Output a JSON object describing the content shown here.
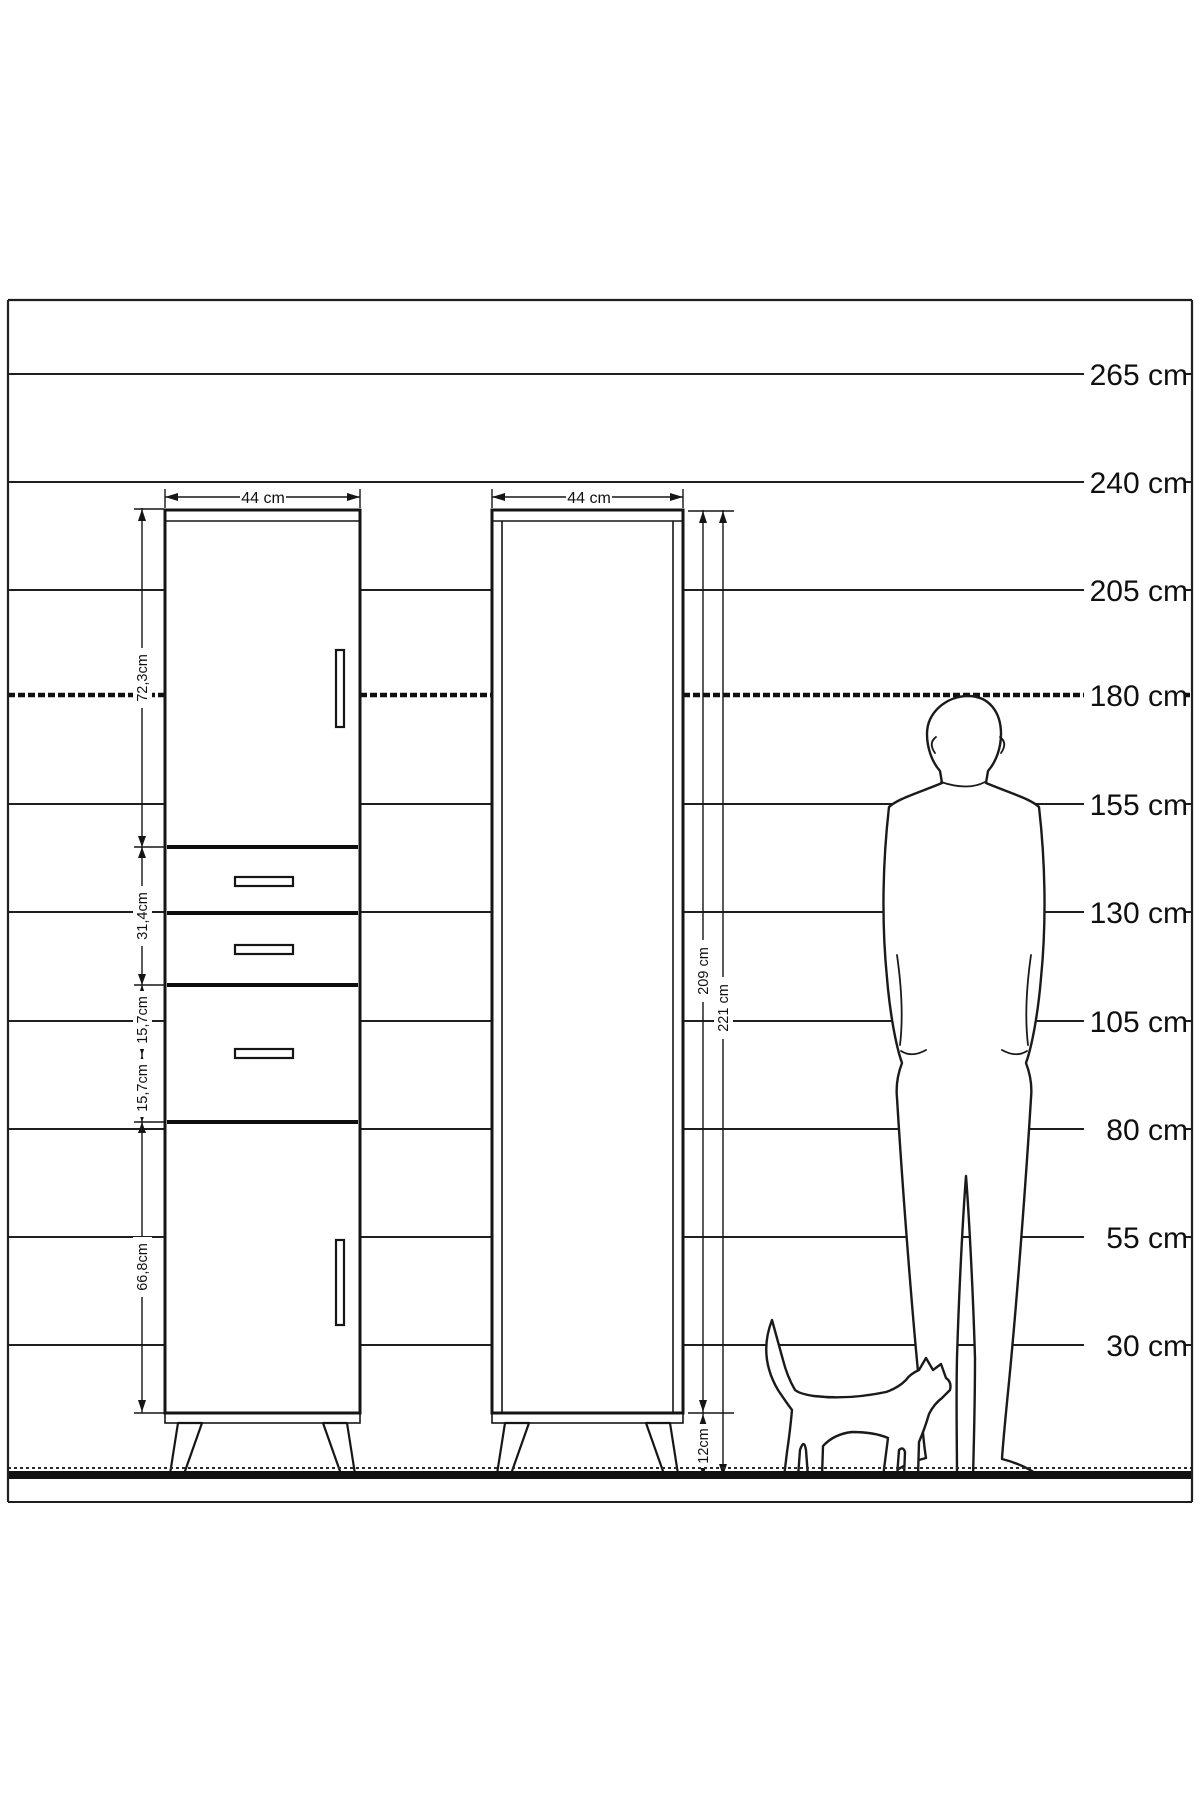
{
  "page": {
    "background": "#ffffff",
    "line_color": "#1a1a1a"
  },
  "scale": {
    "unit": "cm",
    "labels": [
      "265 cm",
      "240 cm",
      "205 cm",
      "180 cm",
      "155 cm",
      "130 cm",
      "105 cm",
      "80 cm",
      "55 cm",
      "30 cm"
    ],
    "values_cm": [
      265,
      240,
      205,
      180,
      155,
      130,
      105,
      80,
      55,
      30
    ],
    "highlighted_line": "180 cm"
  },
  "left_cabinet": {
    "width_label": "44 cm",
    "sections": [
      {
        "label": "72,3cm",
        "part": "upper-door"
      },
      {
        "label": "31,4cm",
        "part": "drawer-1-and-2"
      },
      {
        "label": "15,7cm",
        "part": "drawer-section-upper"
      },
      {
        "label": "15,7cm",
        "part": "drawer-section-lower"
      },
      {
        "label": "66,8cm",
        "part": "lower-door"
      }
    ]
  },
  "right_cabinet": {
    "width_label": "44 cm",
    "body_height_label": "209 cm",
    "total_height_label": "221 cm",
    "leg_height_label": "12cm"
  }
}
